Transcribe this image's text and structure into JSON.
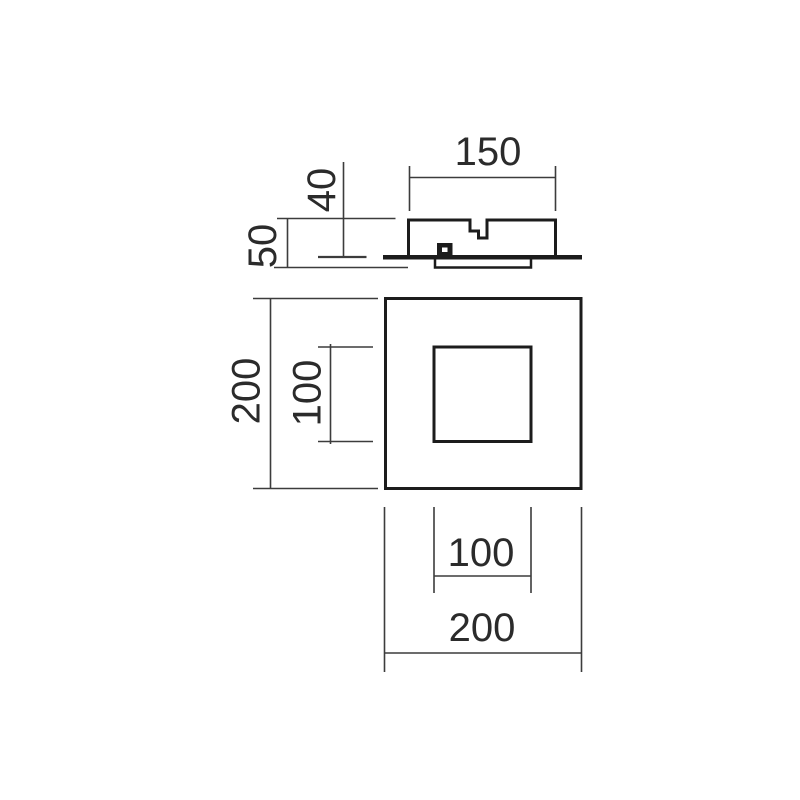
{
  "colors": {
    "line": "#1c1c1c",
    "dim_line": "#3c3c3c",
    "background": "#ffffff"
  },
  "side_view": {
    "dim_width": "150",
    "dim_recess_height": "40",
    "dim_total_height": "50"
  },
  "front_view": {
    "dim_outer_height": "200",
    "dim_inner_height": "100"
  },
  "bottom_dimensions": {
    "dim_inner_width": "100",
    "dim_outer_width": "200"
  }
}
